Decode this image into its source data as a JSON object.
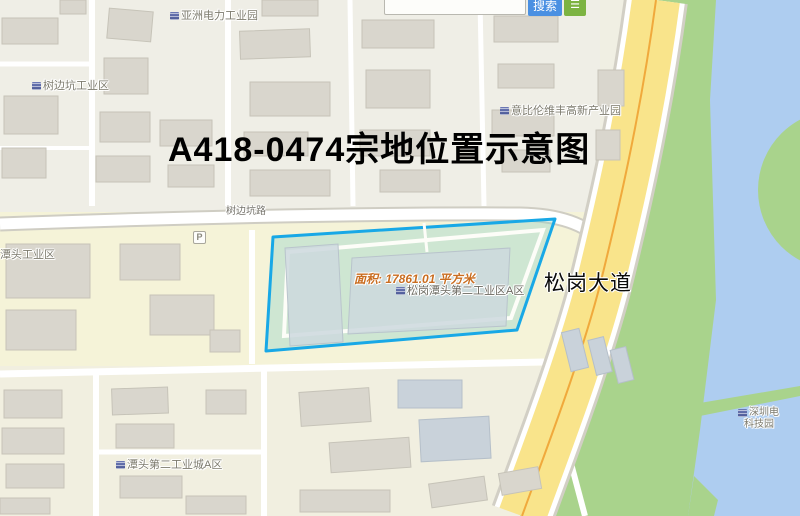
{
  "search": {
    "input_value": "",
    "search_button": "搜索"
  },
  "map": {
    "title": "A418-0474宗地位置示意图",
    "area_annotation": "面积: 17861.01 平方米",
    "roads": {
      "avenue": "松岗大道",
      "north_road": "树边坑路"
    },
    "pois": {
      "asia_power": "亚洲电力工业园",
      "shubiankeng_industrial": "树边坑工业区",
      "yibilun_hitech": "意比伦维丰高新产业园",
      "tantou_industrial": "潭头工业区",
      "songgang_tantou_industrial_a": "松岗潭头第二工业区A区",
      "tantou_second_city_a": "潭头第二工业城A区",
      "shenzhen_label_line1": "深圳电",
      "shenzhen_label_line2": "科技园",
      "parking": "P"
    },
    "colors": {
      "parcel_outline": "#18a8e6",
      "parcel_fill": "#8fd2c8",
      "avenue_fill": "#f9e48b",
      "water": "#aecdf0",
      "greenery": "#a9d38c",
      "building": "#d9d6cd",
      "search_button_blue": "#4a90e2",
      "list_button_green": "#7cb342",
      "area_text_orange": "#c96d20"
    }
  }
}
